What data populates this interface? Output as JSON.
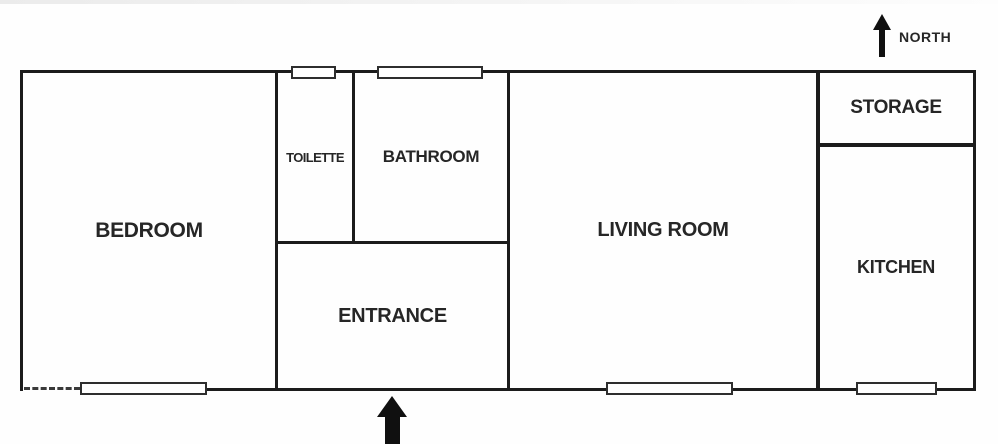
{
  "diagram": {
    "type": "apartment-floor-plan",
    "compass": {
      "label": "NORTH"
    },
    "rooms": [
      {
        "id": "bedroom",
        "label": "BEDROOM"
      },
      {
        "id": "toilette",
        "label": "TOILETTE"
      },
      {
        "id": "bathroom",
        "label": "BATHROOM"
      },
      {
        "id": "entrance",
        "label": "ENTRANCE"
      },
      {
        "id": "living-room",
        "label": "LIVING ROOM"
      },
      {
        "id": "storage",
        "label": "STORAGE"
      },
      {
        "id": "kitchen",
        "label": "KITCHEN"
      }
    ],
    "windows": [
      "toilette-north-window",
      "bathroom-north-window",
      "bedroom-south-window",
      "living-room-south-window",
      "kitchen-south-window"
    ],
    "markers": {
      "entrance_arrow": "main-entrance-arrow",
      "dashed_wall_segment": "bedroom-south-west-dashed"
    },
    "colors": {
      "wall": "#1c1c1c",
      "background": "#ffffff",
      "text": "#262626"
    }
  }
}
